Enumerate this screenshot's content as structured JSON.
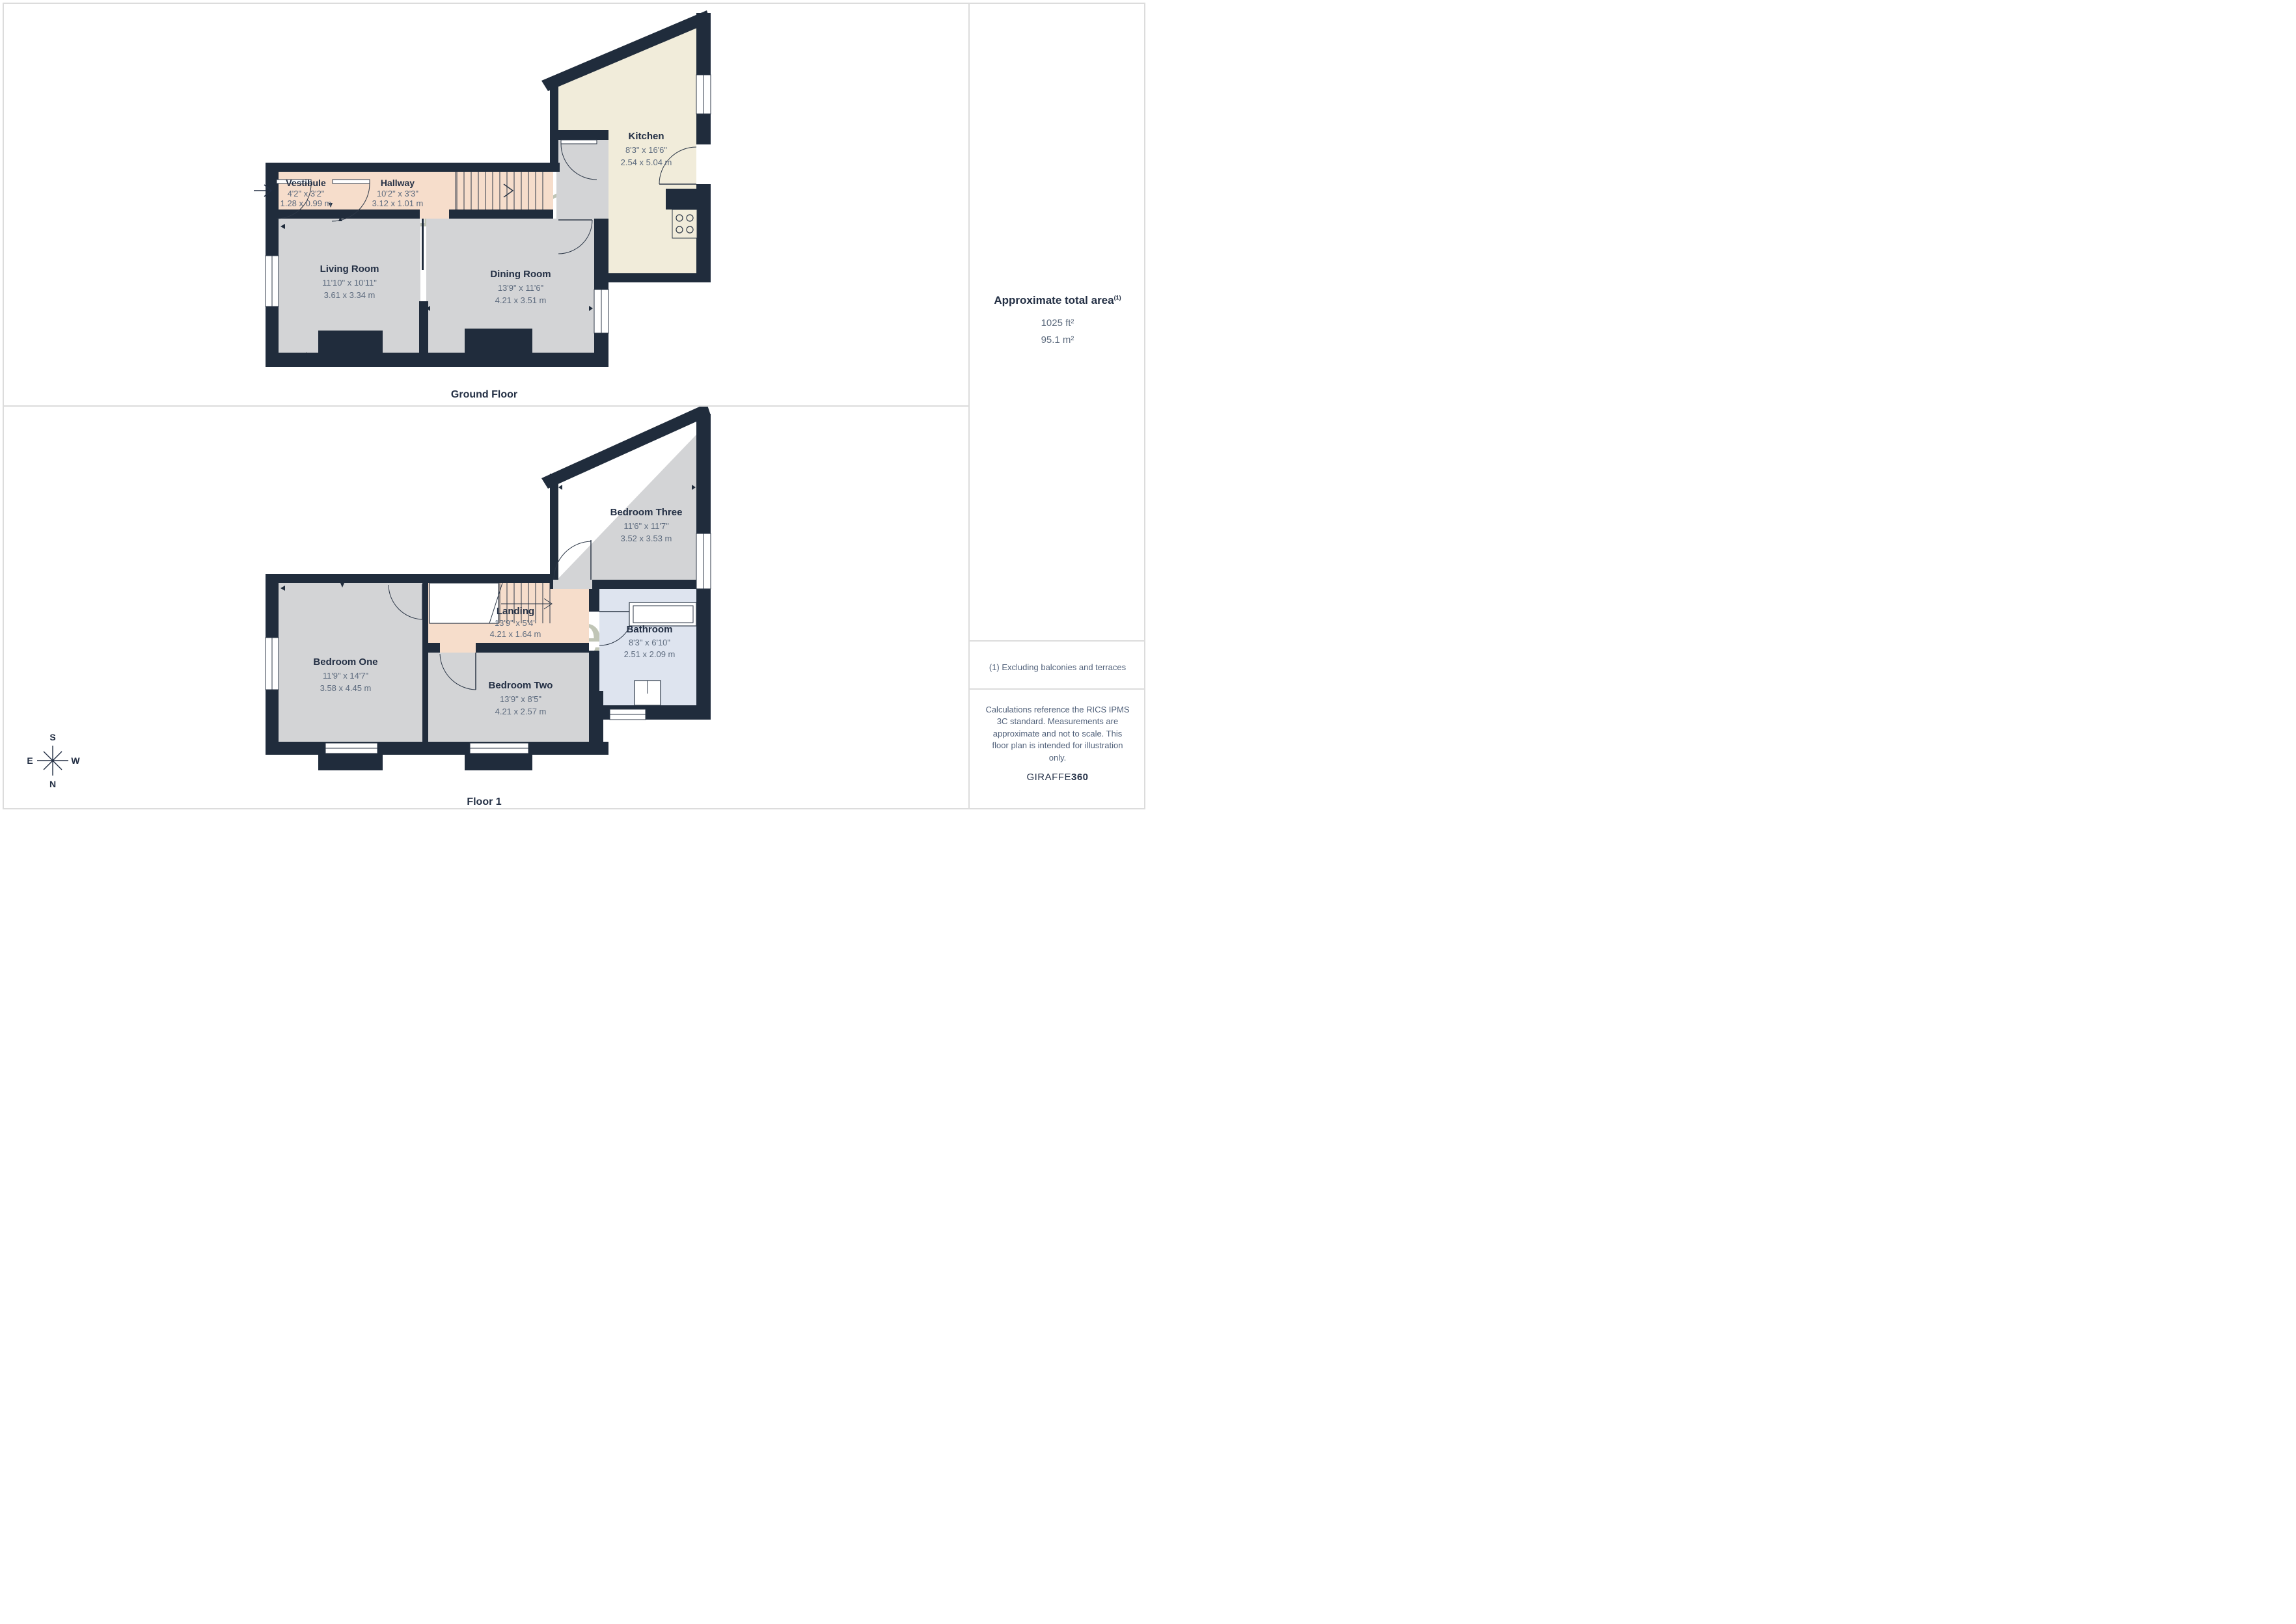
{
  "ground_floor": {
    "caption": "Ground Floor",
    "rooms": [
      {
        "name": "Vestibule",
        "dims_ft": "4'2\" x 3'2\"",
        "dims_m": "1.28 x 0.99 m"
      },
      {
        "name": "Hallway",
        "dims_ft": "10'2\" x 3'3\"",
        "dims_m": "3.12 x 1.01 m"
      },
      {
        "name": "Kitchen",
        "dims_ft": "8'3\" x 16'6\"",
        "dims_m": "2.54 x 5.04 m"
      },
      {
        "name": "Living Room",
        "dims_ft": "11'10\" x 10'11\"",
        "dims_m": "3.61 x 3.34 m"
      },
      {
        "name": "Dining Room",
        "dims_ft": "13'9\" x 11'6\"",
        "dims_m": "4.21 x 3.51 m"
      }
    ]
  },
  "floor_1": {
    "caption": "Floor 1",
    "rooms": [
      {
        "name": "Bedroom Three",
        "dims_ft": "11'6\" x 11'7\"",
        "dims_m": "3.52 x 3.53 m"
      },
      {
        "name": "Landing",
        "dims_ft": "13'9\" x 5'4\"",
        "dims_m": "4.21 x 1.64 m"
      },
      {
        "name": "Bathroom",
        "dims_ft": "8'3\" x 6'10\"",
        "dims_m": "2.51 x 2.09 m"
      },
      {
        "name": "Bedroom One",
        "dims_ft": "11'9\" x 14'7\"",
        "dims_m": "3.58 x 4.45 m"
      },
      {
        "name": "Bedroom Two",
        "dims_ft": "13'9\" x 8'5\"",
        "dims_m": "4.21 x 2.57 m"
      }
    ]
  },
  "sidebar": {
    "area_title": "Approximate total area",
    "area_superscript": "(1)",
    "area_ft": "1025 ft²",
    "area_m": "95.1 m²",
    "footnote": "(1) Excluding balconies and terraces",
    "disclaimer": "Calculations reference the RICS IPMS 3C standard. Measurements are approximate and not to scale. This floor plan is intended for illustration only.",
    "brand": "GIRAFFE",
    "brand_suffix": "360"
  },
  "watermark": {
    "title": "Humphreys",
    "subtitle": "E S T A T E S   &   L E T T I N G S"
  },
  "compass": {
    "n": "N",
    "s": "S",
    "e": "E",
    "w": "W"
  },
  "colors": {
    "wall": "#202c3c",
    "floor_gray": "#d3d4d6",
    "floor_pink": "#f6ddcb",
    "floor_cream": "#f1ecda",
    "floor_blue": "#dee4ef",
    "watermark": "#8d977b",
    "label": "#232f44",
    "dims": "#5d6b7e"
  }
}
